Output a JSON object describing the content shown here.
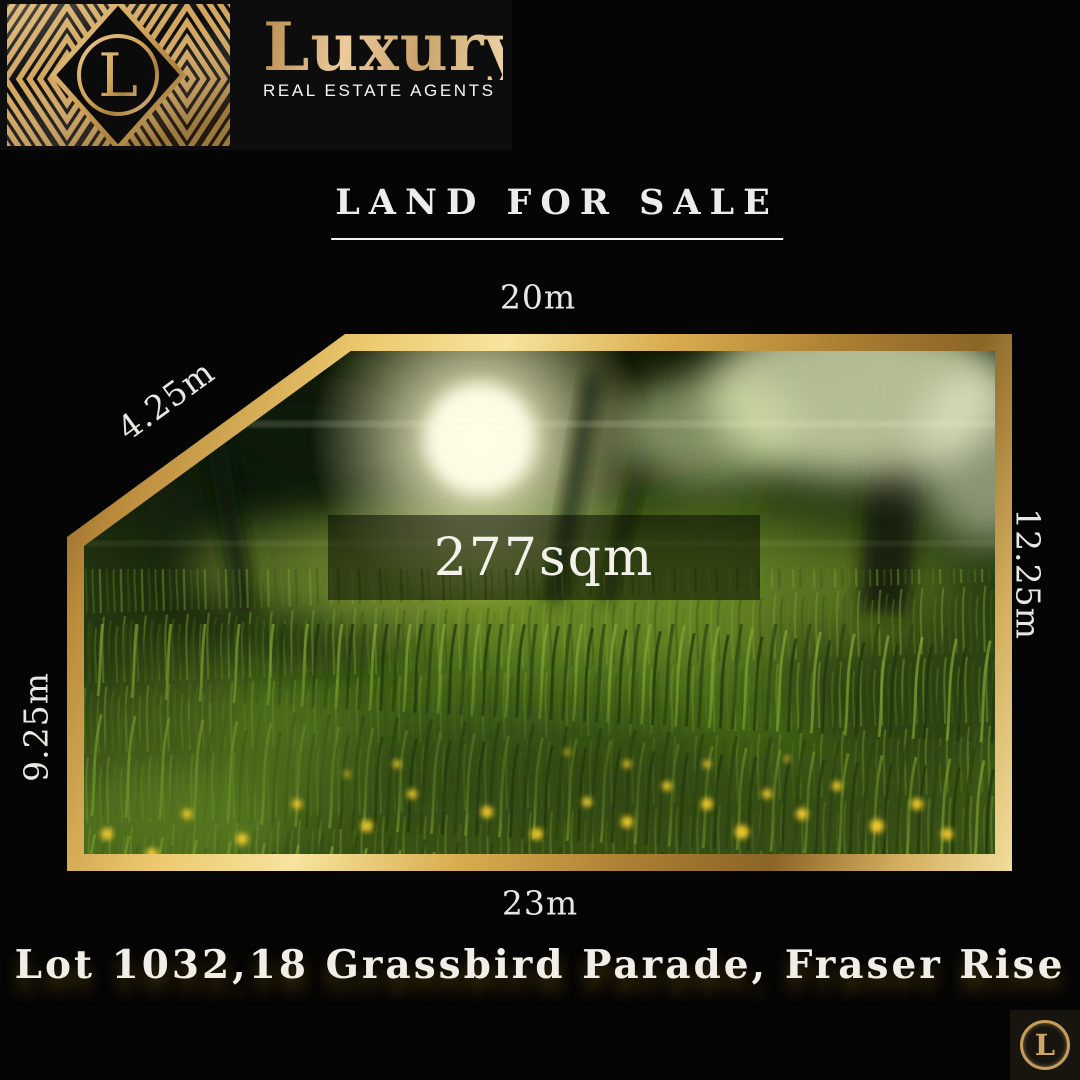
{
  "brand": {
    "name": "Luxury",
    "tagline": "REAL ESTATE AGENTS",
    "monogram": "L"
  },
  "title": {
    "text": "LAND FOR SALE"
  },
  "plot": {
    "area": "277sqm",
    "dim_top": "20m",
    "dim_diagonal": "4.25m",
    "dim_right": "12.25m",
    "dim_left": "9.25m",
    "dim_bottom": "23m"
  },
  "address": {
    "text": "Lot 1032,18 Grassbird Parade, Fraser Rise"
  },
  "colors": {
    "gold": "#d2a55c",
    "gold_light": "#f2d887",
    "background": "#050505",
    "text_light": "#f1eee7"
  }
}
